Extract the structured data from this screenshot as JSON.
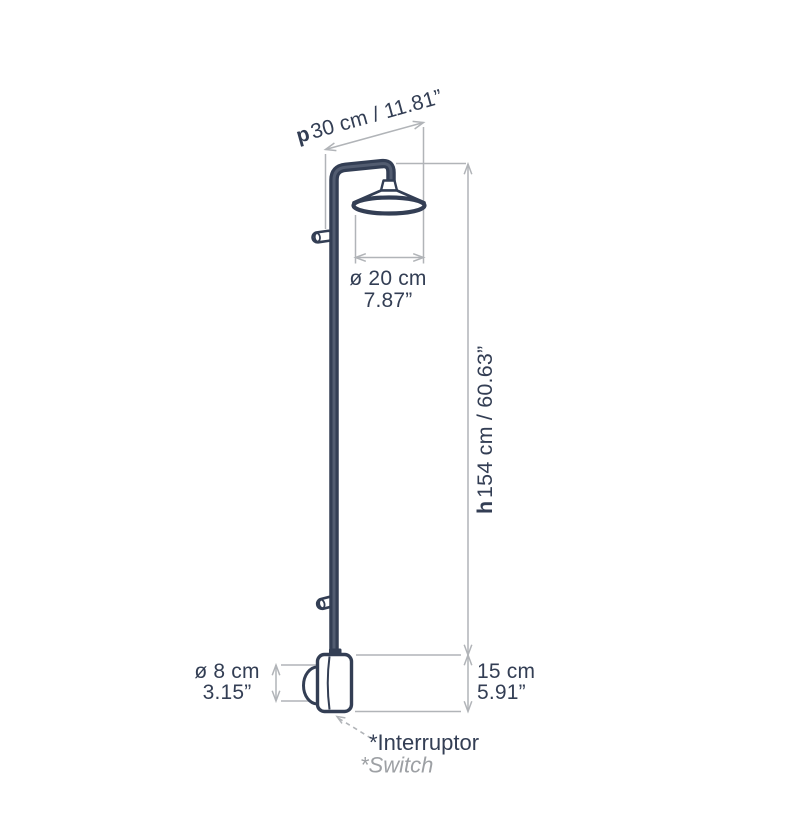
{
  "diagram": {
    "colors": {
      "line_navy": "#333e54",
      "dim_gray": "#b1b4b8",
      "muted_text_gray": "#9da0a4",
      "background": "#ffffff"
    },
    "dim_projection": {
      "prefix": "p",
      "value": "30 cm / 11.81”"
    },
    "dim_shade_diameter": {
      "line1": "ø 20 cm",
      "line2": "7.87”"
    },
    "dim_height": {
      "prefix": "h",
      "value": "154 cm / 60.63”"
    },
    "dim_base_diameter": {
      "line1": "ø 8 cm",
      "line2": "3.15”"
    },
    "dim_base_offset": {
      "line1": "15 cm",
      "line2": "5.91”"
    },
    "note": {
      "es": "*Interruptor",
      "en": "*Switch"
    }
  }
}
